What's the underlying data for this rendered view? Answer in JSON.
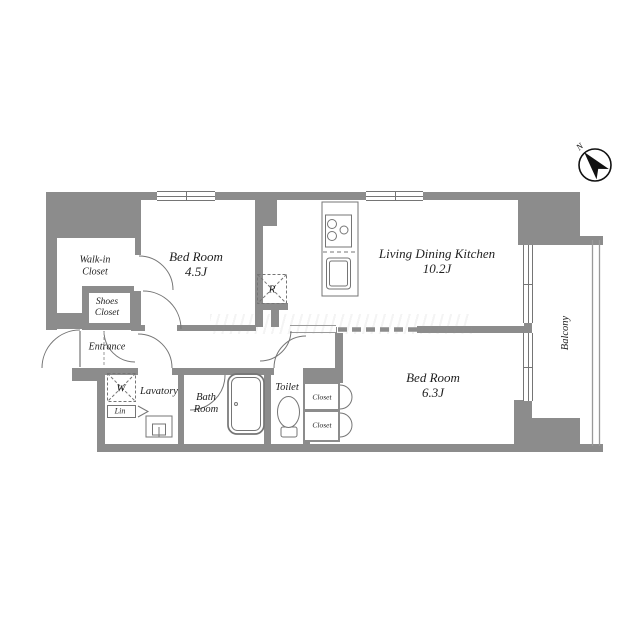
{
  "theme": {
    "bg_color": "#ffffff",
    "wall_color": "#8c8c8c",
    "line_color": "#757575",
    "text_color": "#1f1f1f",
    "ink_color": "#111111"
  },
  "compass": {
    "north_label": "N"
  },
  "rooms": {
    "bedroom1": {
      "name": "Bed Room",
      "size": "4.5J"
    },
    "ldk": {
      "name": "Living Dining Kitchen",
      "size": "10.2J"
    },
    "bedroom2": {
      "name": "Bed Room",
      "size": "6.3J"
    },
    "walk_in_closet": {
      "name_line1": "Walk-in",
      "name_line2": "Closet"
    },
    "shoes_closet": {
      "name_line1": "Shoes",
      "name_line2": "Closet"
    },
    "entrance": {
      "name": "Entrance"
    },
    "lavatory": {
      "name": "Lavatory"
    },
    "bath_room": {
      "name_line1": "Bath",
      "name_line2": "Room"
    },
    "toilet": {
      "name": "Toilet"
    },
    "balcony": {
      "name": "Balcony"
    },
    "closet_upper": {
      "name": "Closet"
    },
    "closet_lower": {
      "name": "Closet"
    },
    "linen": {
      "name": "Lin"
    }
  },
  "fixtures": {
    "washing_machine": {
      "label": "W"
    },
    "refrigerator": {
      "label": "R"
    }
  }
}
